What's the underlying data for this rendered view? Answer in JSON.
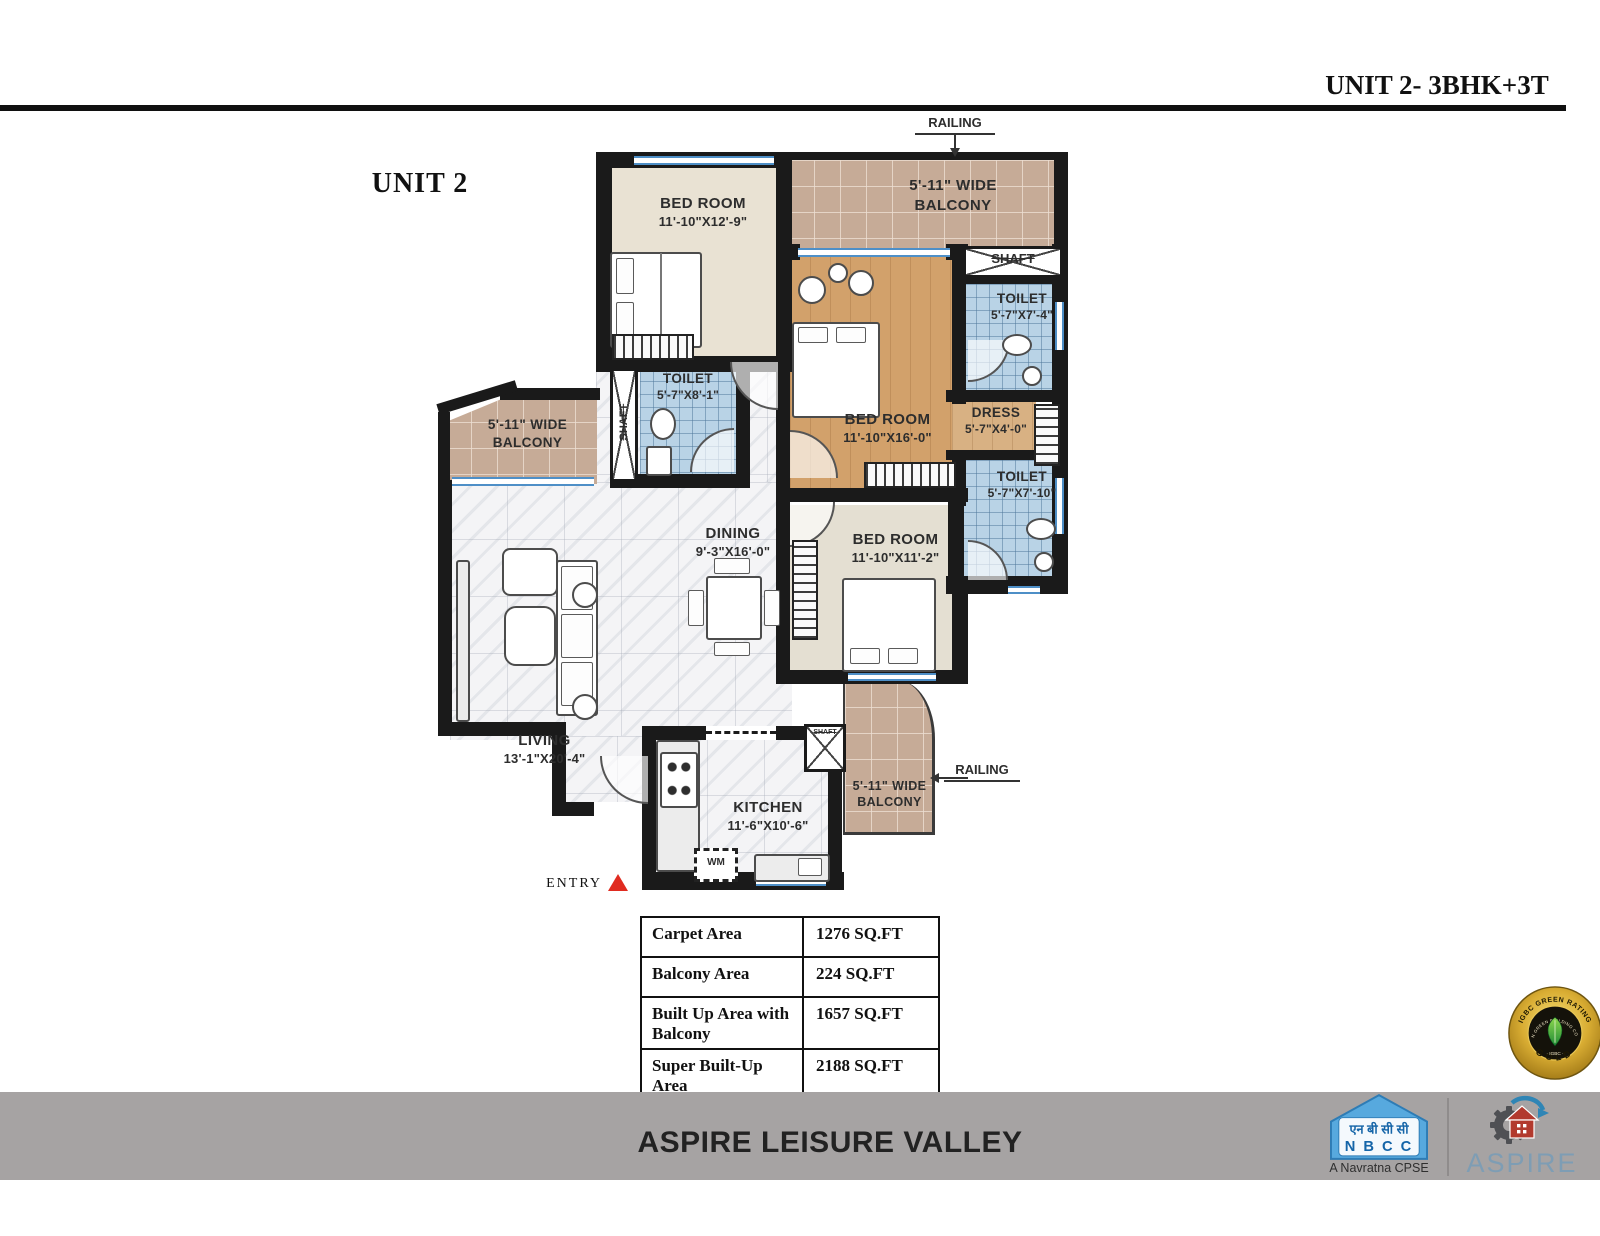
{
  "header": {
    "title": "UNIT 2- 3BHK+3T",
    "unit_label": "UNIT 2"
  },
  "plan": {
    "railing_top": "RAILING",
    "railing_bottom": "RAILING",
    "entry": "ENTRY",
    "wm": "WM",
    "rooms": {
      "bedroom1": {
        "name": "BED ROOM",
        "dims": "11'-10\"X12'-9\""
      },
      "balcony_top": {
        "line1": "5'-11\" WIDE",
        "line2": "BALCONY"
      },
      "shaft_top": "SHAFT",
      "toilet1": {
        "name": "TOILET",
        "dims": "5'-7\"X7'-4\""
      },
      "master": {
        "name": "BED ROOM",
        "dims": "11'-10\"X16'-0\""
      },
      "dress": {
        "name": "DRESS",
        "dims": "5'-7\"X4'-0\""
      },
      "toilet2": {
        "name": "TOILET",
        "dims": "5'-7\"X7'-10\""
      },
      "toilet3": {
        "name": "TOILET",
        "dims": "5'-7\"X8'-1\""
      },
      "shaft_left": "SHAFT",
      "shaft_kitchen": "SHAFT",
      "balcony_left": {
        "line1": "5'-11\" WIDE",
        "line2": "BALCONY"
      },
      "dining": {
        "name": "DINING",
        "dims": "9'-3\"X16'-0\""
      },
      "bedroom3": {
        "name": "BED ROOM",
        "dims": "11'-10\"X11'-2\""
      },
      "living": {
        "name": "LIVING",
        "dims": "13'-1\"X20'-4\""
      },
      "kitchen": {
        "name": "KITCHEN",
        "dims": "11'-6\"X10'-6\""
      },
      "balcony_bottom": {
        "line1": "5'-11\" WIDE",
        "line2": "BALCONY"
      }
    }
  },
  "area_table": {
    "rows": [
      {
        "label": "Carpet Area",
        "value": "1276 SQ.FT"
      },
      {
        "label": "Balcony Area",
        "value": "224 SQ.FT"
      },
      {
        "label": "Built Up Area with Balcony",
        "value": "1657 SQ.FT"
      },
      {
        "label": "Super Built-Up Area",
        "value": "2188 SQ.FT"
      }
    ]
  },
  "badge": {
    "arc_top": "IGBC GREEN RATING",
    "arc_inner": "INDIAN GREEN BUILDING COUNCIL",
    "center": "· IGBC ·",
    "bottom": "GOLD"
  },
  "footer": {
    "project": "ASPIRE LEISURE VALLEY",
    "nbcc_hindi": "एन बी सी सी",
    "nbcc_name": "N B C C",
    "nbcc_tagline": "A Navratna CPSE",
    "aspire_name": "ASPIRE"
  },
  "colors": {
    "wall": "#1a1a1a",
    "tile_blue": "#b9d3e6",
    "wood": "#d2a16b",
    "balcony_tan": "#c6ab97",
    "footer_gray": "#a6a3a3",
    "badge_gold": "#d9ad33",
    "entry_red": "#e02b20",
    "nbcc_blue": "#57a9de",
    "aspire_text_blue": "#7e9db4"
  }
}
